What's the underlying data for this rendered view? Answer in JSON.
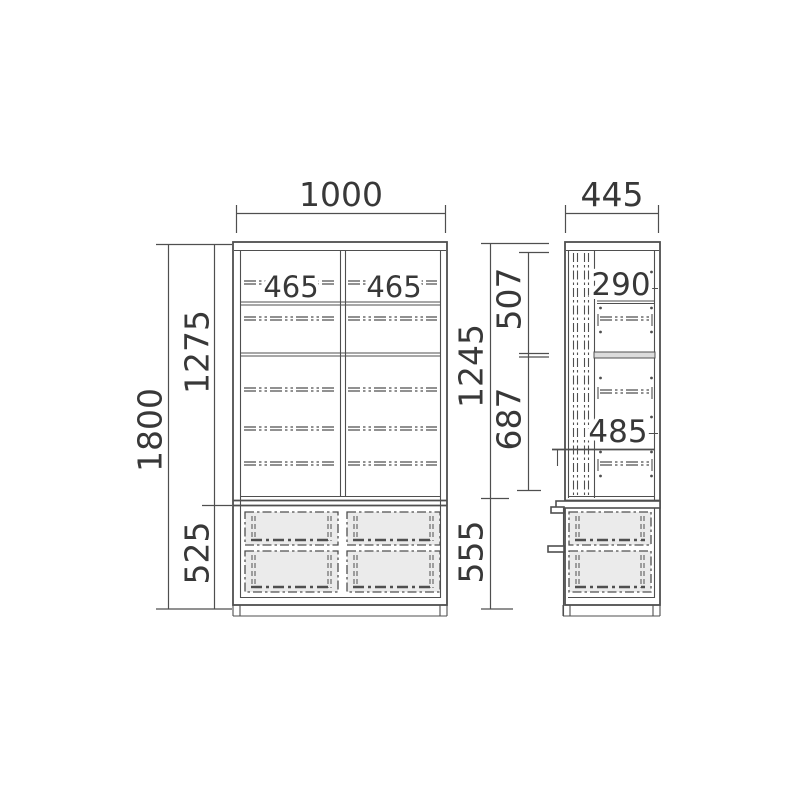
{
  "drawing_type": "furniture-dimension-diagram",
  "dimensions": {
    "front_width": "1000",
    "front_total_height": "1800",
    "front_upper_height": "1275",
    "front_lower_height": "525",
    "front_compartment_width_left": "465",
    "front_compartment_width_right": "465",
    "side_depth": "445",
    "side_upper_height": "1245",
    "side_lower_height": "555",
    "side_top_section": "507",
    "side_bottom_section": "687",
    "side_shelf_space_top": "290",
    "side_shelf_space_bottom": "485"
  },
  "colors": {
    "line": "#4f4f4f",
    "text": "#383838",
    "drawer_fill": "#ebebeb",
    "shelf_fill": "#dcdcdc",
    "background": "#ffffff"
  }
}
